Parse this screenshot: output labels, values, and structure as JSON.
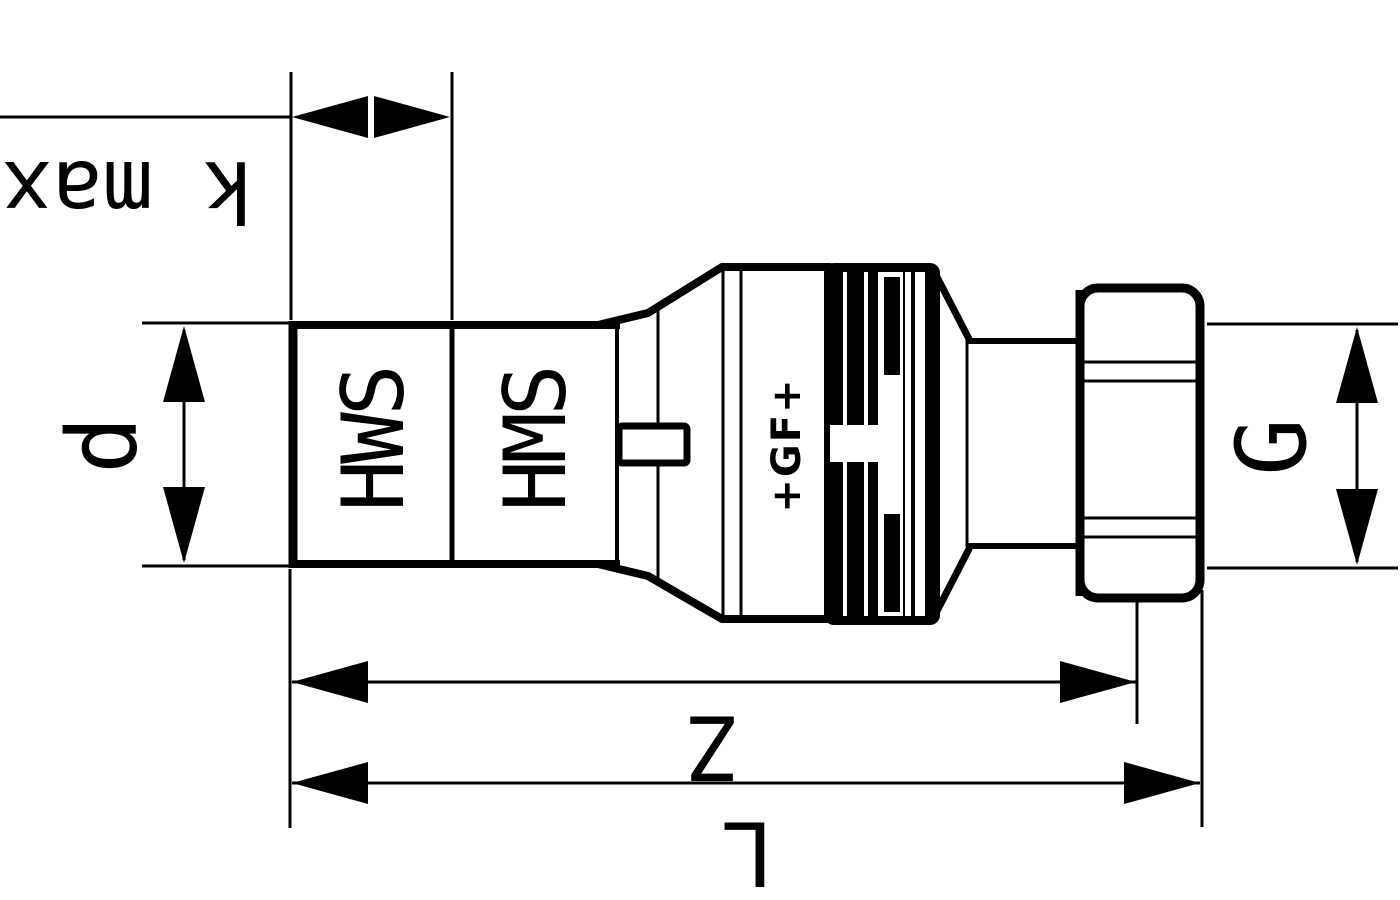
{
  "diagram": {
    "type": "technical-drawing",
    "subject": "pipe union adapter fitting, side view",
    "background_color": "#ffffff",
    "ink_color": "#000000",
    "dimensions": {
      "k_max": {
        "label": "k max",
        "meaning": "socket insertion depth"
      },
      "d": {
        "label": "d",
        "meaning": "pipe outside diameter"
      },
      "g": {
        "label": "G",
        "meaning": "union nut thread size"
      },
      "z": {
        "label": "Z",
        "meaning": "length to nut face"
      },
      "l": {
        "label": "L",
        "meaning": "overall length"
      }
    },
    "markings": {
      "socket_section_1": "HWS",
      "socket_section_2": "HMS",
      "brand": "+GF+"
    }
  }
}
